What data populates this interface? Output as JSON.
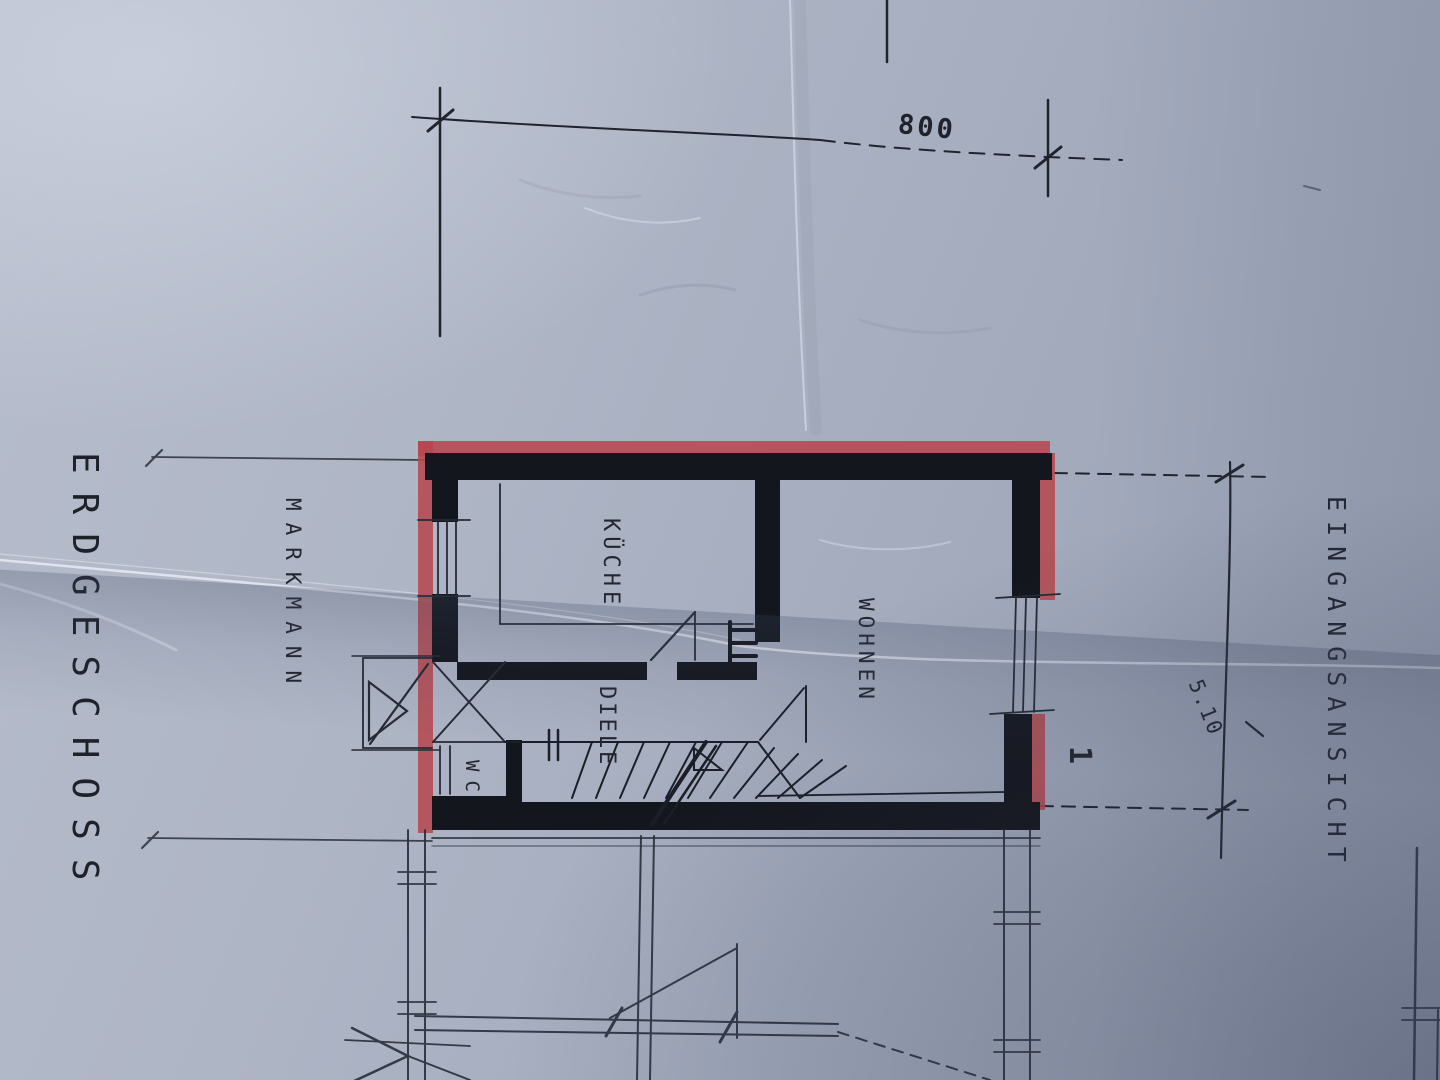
{
  "plan": {
    "floor_title": "ERDGESCHOSS",
    "owner_name": "MARKMANN",
    "view_label": "EINGANGSANSICHT",
    "rooms": [
      {
        "label": "KÜCHE"
      },
      {
        "label": "WOHNEN"
      },
      {
        "label": "DIELE"
      },
      {
        "label": "WC"
      }
    ],
    "dimensions": {
      "top_width": "800",
      "right_height": "5.10"
    },
    "stair_label": "1"
  },
  "colors": {
    "paper": "#a9b0c0",
    "ink": "#14161d",
    "marker_red": "#b4494f"
  }
}
